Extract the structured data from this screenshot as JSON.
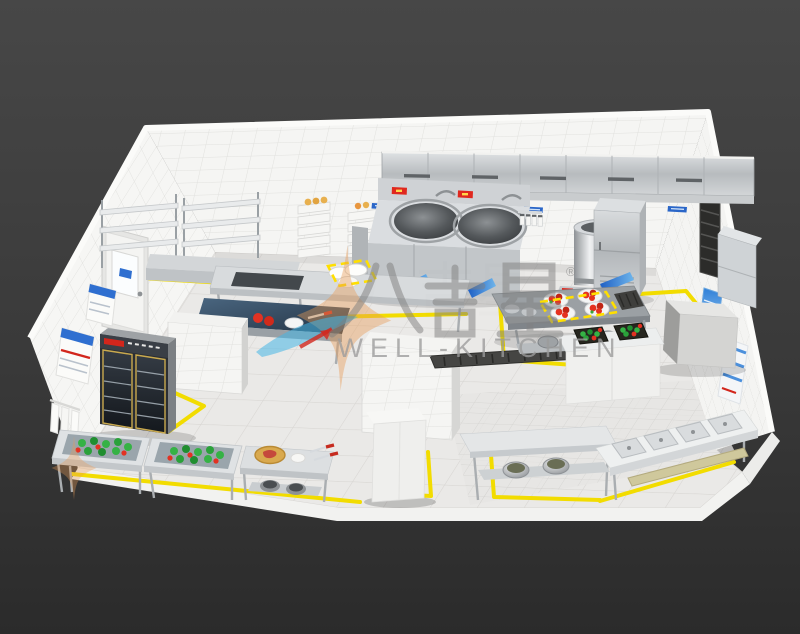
{
  "watermark": {
    "brand_cn": "八吉星",
    "registered_mark": "®",
    "brand_en": "WELL-KITCHEN"
  },
  "colors": {
    "background_dark": "#3a3a3a",
    "wall_tile": "#f5f5f3",
    "floor_tile": "#e9e8e6",
    "stainless_steel": "#c6c9cc",
    "floor_marking_yellow": "#f2dc00",
    "wall_label_blue": "#2a66c8",
    "vegetable_green": "#2fae3f",
    "tomato_red": "#e23222",
    "watermark_gray": "#8a8a8a",
    "logo_orange": "#e89a55",
    "logo_blue": "#45b7e6"
  },
  "equipment": [
    "exhaust-hood",
    "double-wok-range",
    "soup-kettle",
    "steam-cabinet",
    "side-cabinet",
    "wall-shelving",
    "steamer-stacks",
    "prep-sink-table",
    "dark-top-counter",
    "tile-partition",
    "service-island",
    "vegetable-trays",
    "walk-in-cube",
    "glass-door-refrigerator",
    "vegetable-wash-sinks",
    "cutting-board-table",
    "upright-cabinet",
    "pot-table",
    "four-compartment-sink",
    "door",
    "wall-posters"
  ]
}
